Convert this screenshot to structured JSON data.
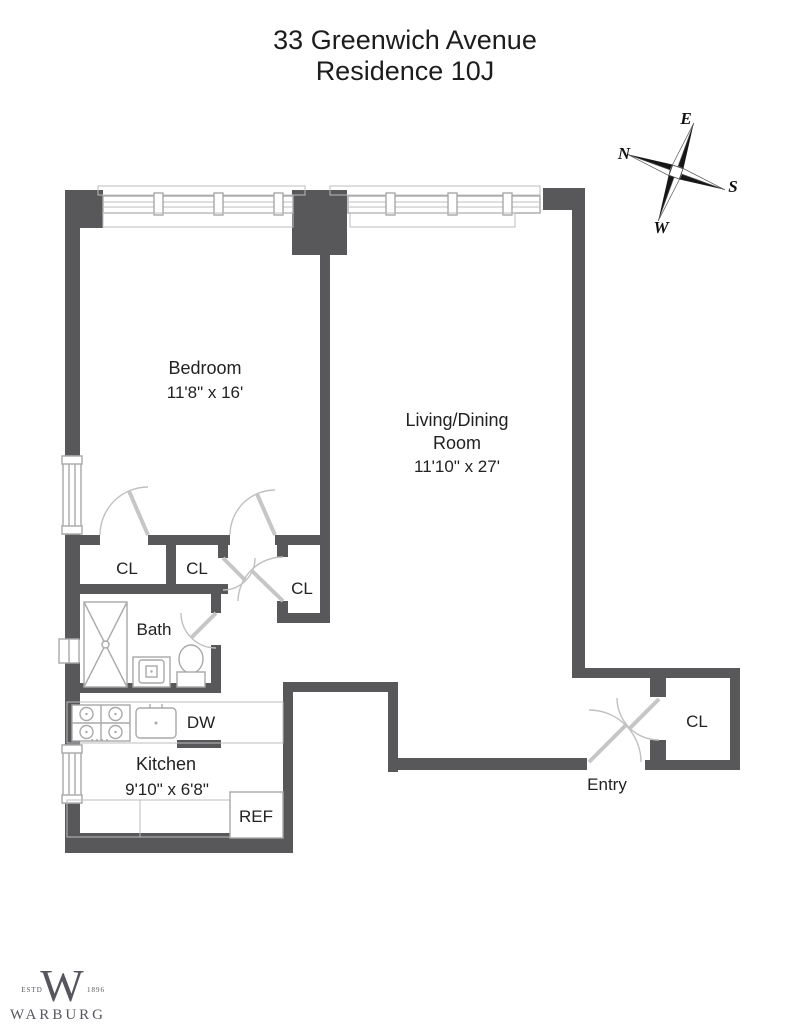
{
  "title": {
    "line1": "33 Greenwich Avenue",
    "line2": "Residence 10J"
  },
  "compass": {
    "north": "N",
    "east": "E",
    "south": "S",
    "west": "W"
  },
  "rooms": {
    "bedroom": {
      "name": "Bedroom",
      "dimensions": "11'8\" x 16'"
    },
    "living_dining": {
      "name_line1": "Living/Dining",
      "name_line2": "Room",
      "dimensions": "11'10\" x 27'"
    },
    "kitchen": {
      "name": "Kitchen",
      "dimensions": "9'10\" x 6'8\""
    },
    "bath": {
      "name": "Bath"
    },
    "entry": {
      "name": "Entry"
    }
  },
  "closets": {
    "bedroom_closet": "CL",
    "hall_closet_left": "CL",
    "hall_closet_mid": "CL",
    "entry_closet": "CL"
  },
  "appliances": {
    "dishwasher": "DW",
    "refrigerator": "REF"
  },
  "logo": {
    "monogram": "W",
    "estd": "ESTD",
    "year": "1896",
    "name": "WARBURG"
  },
  "colors": {
    "wall": "#58585a",
    "fixture_line": "#a9a9a9",
    "door_line": "#c0c0c0",
    "text": "#222222",
    "logo": "#56565f"
  }
}
